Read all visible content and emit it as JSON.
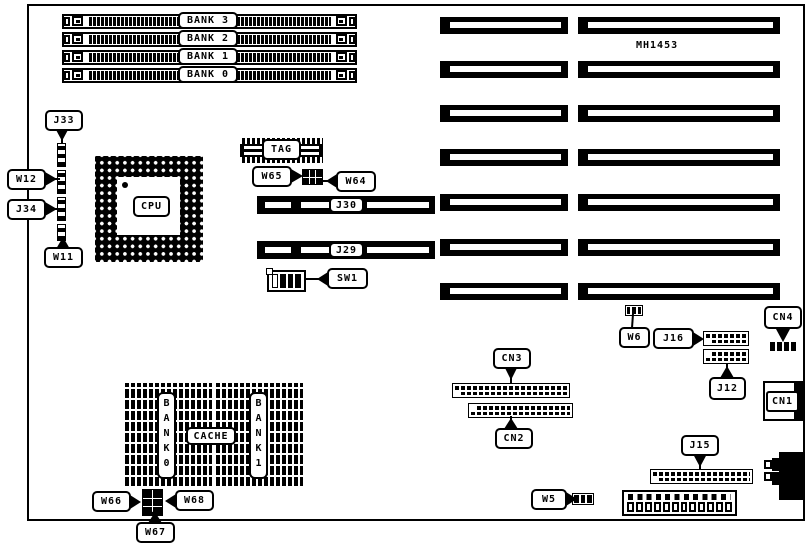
{
  "board": {
    "part_number": "MH1453"
  },
  "memory": {
    "banks": [
      {
        "label": "BANK 3"
      },
      {
        "label": "BANK 2"
      },
      {
        "label": "BANK 1"
      },
      {
        "label": "BANK 0"
      }
    ]
  },
  "cpu": {
    "label": "CPU"
  },
  "tag": {
    "label": "TAG"
  },
  "cache": {
    "label": "CACHE",
    "bank0_label": "B\nA\nN\nK\n0",
    "bank1_label": "B\nA\nN\nK\n1"
  },
  "jumpers": {
    "w5": "W5",
    "w6": "W6",
    "w11": "W11",
    "w12": "W12",
    "w64": "W64",
    "w65": "W65",
    "w66": "W66",
    "w67": "W67",
    "w68": "W68"
  },
  "connectors": {
    "j12": "J12",
    "j15": "J15",
    "j16": "J16",
    "j29": "J29",
    "j30": "J30",
    "j33": "J33",
    "j34": "J34",
    "cn1": "CN1",
    "cn2": "CN2",
    "cn3": "CN3",
    "cn4": "CN4"
  },
  "switches": {
    "sw1": "SW1"
  }
}
